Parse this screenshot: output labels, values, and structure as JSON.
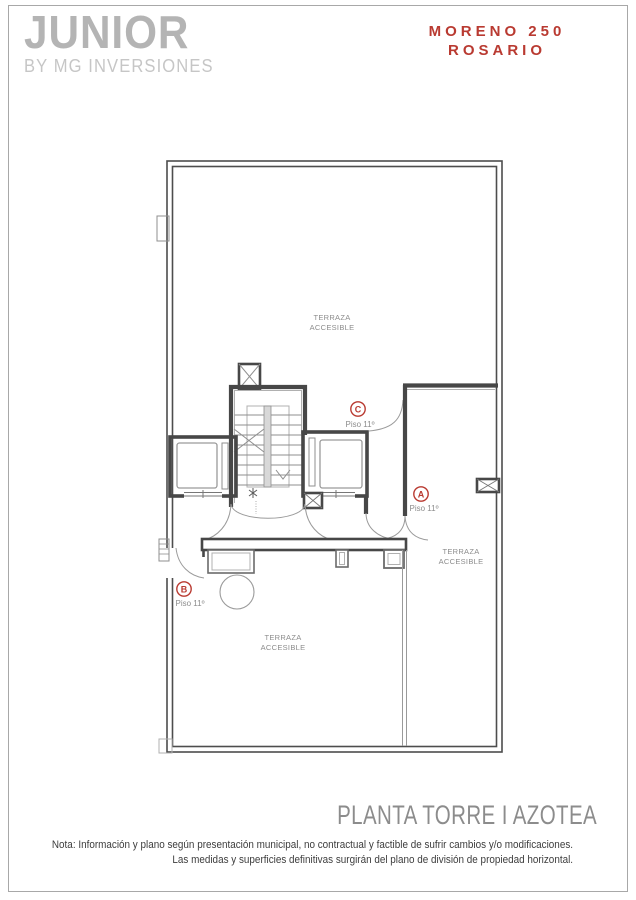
{
  "header": {
    "logo_title": "JUNIOR",
    "logo_subtitle": "BY MG INVERSIONES",
    "project_name": "MORENO 250",
    "project_city": "ROSARIO"
  },
  "plan": {
    "units": [
      {
        "letter": "C",
        "floor": "Piso 11º"
      },
      {
        "letter": "A",
        "floor": "Piso 11º"
      },
      {
        "letter": "B",
        "floor": "Piso 11º"
      }
    ],
    "areas": [
      {
        "line1": "TERRAZA",
        "line2": "ACCESIBLE"
      },
      {
        "line1": "TERRAZA",
        "line2": "ACCESIBLE"
      },
      {
        "line1": "TERRAZA",
        "line2": "ACCESIBLE"
      }
    ]
  },
  "footer": {
    "plan_title": "PLANTA TORRE I AZOTEA",
    "note_line1": "Nota: Información y plano según presentación municipal, no contractual y factible de sufrir cambios y/o modificaciones.",
    "note_line2": "Las medidas y superficies  definitivas surgirán del plano de división de propiedad horizontal."
  },
  "colors": {
    "accent_red": "#b93a31",
    "logo_gray": "#b4b4b4",
    "wall_dark": "#474747"
  }
}
